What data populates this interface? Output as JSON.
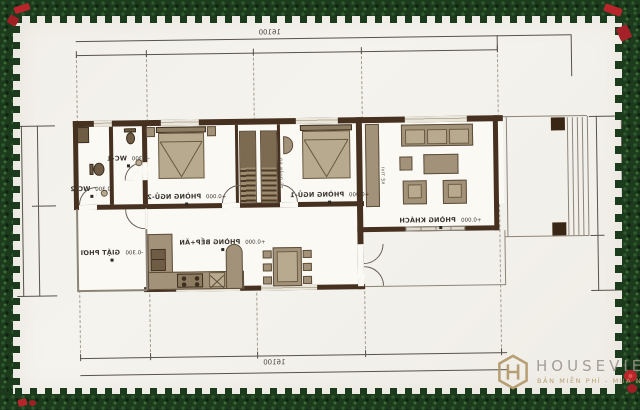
{
  "watermark": {
    "brand": "HOUSEVIET",
    "tagline": "BẢN MIỄN PHÍ - MUA NHƯ Ý"
  },
  "dimensions": {
    "top": "16100",
    "bottom": "16100"
  },
  "rooms": {
    "wc1": {
      "name": "WC-1",
      "elevation": "-0.300"
    },
    "wc2": {
      "name": "WC-2",
      "elevation": "-0.300"
    },
    "bedroom2": {
      "name": "PHÒNG NGỦ-2",
      "elevation": "+0.000"
    },
    "bedroom1": {
      "name": "PHÒNG NGỦ-1",
      "elevation": "+0.000"
    },
    "living": {
      "name": "PHÒNG KHÁCH",
      "elevation": "+0.000"
    },
    "kitchen": {
      "name": "PHÒNG BẾP+ĂN",
      "elevation": "+0.000"
    },
    "laundry": {
      "name": "GIẶT PHƠI",
      "elevation": "-0.300"
    }
  },
  "furniture_labels": {
    "wardrobe": "TỦ QUẦN ÁO",
    "tv_shelf": "KỆ TIVI"
  },
  "colors": {
    "wall": "#46301f",
    "furniture": "#a3927a",
    "garland_green": "#1c3a1c",
    "bow_red": "#b8262c",
    "watermark_tan": "#b59a6e"
  }
}
